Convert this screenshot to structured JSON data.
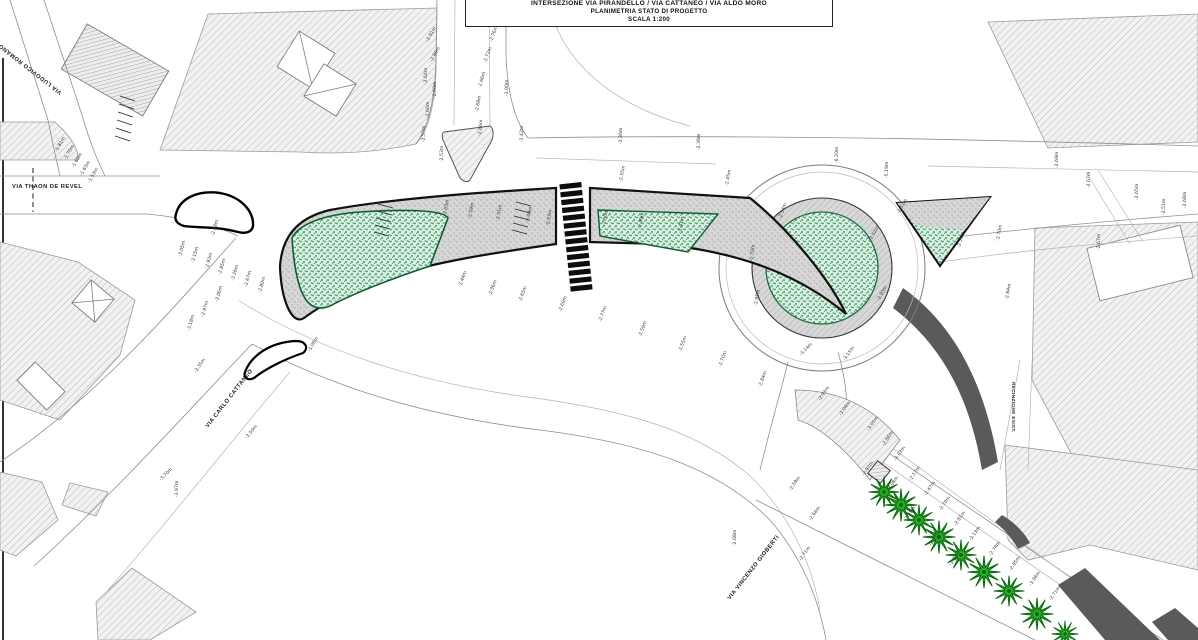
{
  "title_block": {
    "line1": "INTERSEZIONE VIA PIRANDELLO / VIA CATTANEO / VIA ALDO MORO",
    "line2": "PLANIMETRIA STATO DI PROGETTO",
    "line3": "SCALA 1:200"
  },
  "colors": {
    "island_green_dot": "#2f9a57",
    "island_green_base": "#daf0e3",
    "tree_green": "#2fb82a",
    "tree_green_dark": "#0c6b10",
    "apron_gray": "#d8d8d8",
    "median_gray": "#d7d7d7",
    "dark_strip": "#5a5a5a",
    "road_line_gray": "#8f8f8f",
    "outline_black": "#111111",
    "crosswalk_black": "#0d0d0d"
  },
  "street_labels": [
    {
      "text": "VIA THAON DE REVEL",
      "x": 12,
      "y": 188,
      "rot": 0
    },
    {
      "text": "VIA LUDOVICO ROMANO",
      "x": 62,
      "y": 92,
      "rot": 218
    },
    {
      "text": "VIA CARLO CATTANEO",
      "x": 208,
      "y": 428,
      "rot": -52
    },
    {
      "text": "VIA VINCENZO GIOBERTI",
      "x": 730,
      "y": 600,
      "rot": -52
    }
  ],
  "vertical_labels": [
    {
      "text": "RECINZIONE ESIST.",
      "x": 1012,
      "y": 382,
      "rot": 90
    }
  ],
  "crosswalk": {
    "cx": 575,
    "cy": 237,
    "x": 565,
    "y0": 183,
    "count": 14,
    "w": 22,
    "h": 5.2,
    "step": 7.9,
    "rot": -6
  },
  "trees": [
    {
      "x": 884,
      "y": 492,
      "r": 15
    },
    {
      "x": 901,
      "y": 505,
      "r": 16
    },
    {
      "x": 919,
      "y": 520,
      "r": 15
    },
    {
      "x": 939,
      "y": 537,
      "r": 16
    },
    {
      "x": 961,
      "y": 555,
      "r": 15
    },
    {
      "x": 984,
      "y": 572,
      "r": 16
    },
    {
      "x": 1009,
      "y": 591,
      "r": 15
    },
    {
      "x": 1037,
      "y": 614,
      "r": 16
    },
    {
      "x": 1065,
      "y": 634,
      "r": 13
    }
  ],
  "elevations": [
    {
      "x": 57,
      "y": 152,
      "r": -60,
      "t": "-1.81m"
    },
    {
      "x": 66,
      "y": 160,
      "r": -60,
      "t": "-1.70m"
    },
    {
      "x": 74,
      "y": 168,
      "r": -60,
      "t": "-1.68m"
    },
    {
      "x": 82,
      "y": 176,
      "r": -60,
      "t": "-1.63m"
    },
    {
      "x": 90,
      "y": 183,
      "r": -60,
      "t": "-1.53m"
    },
    {
      "x": 428,
      "y": 42,
      "r": -60,
      "t": "-2.91m"
    },
    {
      "x": 432,
      "y": 62,
      "r": -60,
      "t": "-2.86m"
    },
    {
      "x": 427,
      "y": 84,
      "r": -90,
      "t": "-2.64m"
    },
    {
      "x": 436,
      "y": 98,
      "r": -90,
      "t": "-2.60m"
    },
    {
      "x": 429,
      "y": 118,
      "r": -90,
      "t": "-2.66m"
    },
    {
      "x": 425,
      "y": 142,
      "r": -90,
      "t": "-2.57m"
    },
    {
      "x": 443,
      "y": 162,
      "r": -90,
      "t": "-2.53m"
    },
    {
      "x": 492,
      "y": 42,
      "r": -70,
      "t": "-2.76m"
    },
    {
      "x": 486,
      "y": 63,
      "r": -70,
      "t": "-2.72m"
    },
    {
      "x": 481,
      "y": 88,
      "r": -75,
      "t": "-2.66m"
    },
    {
      "x": 478,
      "y": 112,
      "r": -80,
      "t": "-2.68m"
    },
    {
      "x": 481,
      "y": 136,
      "r": -85,
      "t": "-2.86m"
    },
    {
      "x": 508,
      "y": 96,
      "r": -90,
      "t": "-3.00m"
    },
    {
      "x": 523,
      "y": 142,
      "r": -90,
      "t": "-2.42m"
    },
    {
      "x": 622,
      "y": 144,
      "r": -90,
      "t": "-2.36m"
    },
    {
      "x": 700,
      "y": 150,
      "r": -90,
      "t": "-2.38m"
    },
    {
      "x": 838,
      "y": 163,
      "r": -90,
      "t": "-6.20m"
    },
    {
      "x": 888,
      "y": 178,
      "r": -90,
      "t": "-5.19m"
    },
    {
      "x": 1058,
      "y": 168,
      "r": -90,
      "t": "-2.69m"
    },
    {
      "x": 1090,
      "y": 188,
      "r": -90,
      "t": "-2.67m"
    },
    {
      "x": 1138,
      "y": 200,
      "r": -90,
      "t": "-2.65m"
    },
    {
      "x": 1165,
      "y": 215,
      "r": -90,
      "t": "-2.51m"
    },
    {
      "x": 1186,
      "y": 208,
      "r": -90,
      "t": "-2.68m"
    },
    {
      "x": 181,
      "y": 257,
      "r": -75,
      "t": "-3.05m"
    },
    {
      "x": 194,
      "y": 263,
      "r": -75,
      "t": "-3.15m"
    },
    {
      "x": 208,
      "y": 269,
      "r": -75,
      "t": "-2.93m"
    },
    {
      "x": 221,
      "y": 275,
      "r": -75,
      "t": "-2.85m"
    },
    {
      "x": 234,
      "y": 281,
      "r": -75,
      "t": "-3.26m"
    },
    {
      "x": 247,
      "y": 287,
      "r": -75,
      "t": "-2.67m"
    },
    {
      "x": 261,
      "y": 293,
      "r": -75,
      "t": "-2.80m"
    },
    {
      "x": 218,
      "y": 302,
      "r": -75,
      "t": "-3.06m"
    },
    {
      "x": 204,
      "y": 317,
      "r": -75,
      "t": "-2.97m"
    },
    {
      "x": 190,
      "y": 331,
      "r": -75,
      "t": "-3.18m"
    },
    {
      "x": 214,
      "y": 236,
      "r": -75,
      "t": "-2.88m"
    },
    {
      "x": 446,
      "y": 216,
      "r": -80,
      "t": "-2.63m"
    },
    {
      "x": 471,
      "y": 219,
      "r": -80,
      "t": "-2.59m"
    },
    {
      "x": 499,
      "y": 221,
      "r": -80,
      "t": "-2.51m"
    },
    {
      "x": 529,
      "y": 223,
      "r": -80,
      "t": "-2.48m"
    },
    {
      "x": 549,
      "y": 226,
      "r": -80,
      "t": "-2.63m"
    },
    {
      "x": 605,
      "y": 226,
      "r": -80,
      "t": "-2.55m"
    },
    {
      "x": 641,
      "y": 229,
      "r": -80,
      "t": "-2.49m"
    },
    {
      "x": 681,
      "y": 233,
      "r": -80,
      "t": "-2.41m"
    },
    {
      "x": 461,
      "y": 287,
      "r": -70,
      "t": "-2.44m"
    },
    {
      "x": 491,
      "y": 296,
      "r": -70,
      "t": "-2.36m"
    },
    {
      "x": 521,
      "y": 302,
      "r": -70,
      "t": "-2.65m"
    },
    {
      "x": 561,
      "y": 312,
      "r": -70,
      "t": "-2.69m"
    },
    {
      "x": 601,
      "y": 322,
      "r": -70,
      "t": "-2.77m"
    },
    {
      "x": 641,
      "y": 337,
      "r": -70,
      "t": "-2.59m"
    },
    {
      "x": 681,
      "y": 352,
      "r": -70,
      "t": "-2.55m"
    },
    {
      "x": 721,
      "y": 367,
      "r": -70,
      "t": "-2.70m"
    },
    {
      "x": 761,
      "y": 387,
      "r": -70,
      "t": "-2.84m"
    },
    {
      "x": 622,
      "y": 182,
      "r": -80,
      "t": "-2.55m"
    },
    {
      "x": 728,
      "y": 186,
      "r": -80,
      "t": "-2.45m"
    },
    {
      "x": 781,
      "y": 219,
      "r": -70,
      "t": "-2.54m"
    },
    {
      "x": 899,
      "y": 214,
      "r": -60,
      "t": "-2.51m"
    },
    {
      "x": 871,
      "y": 241,
      "r": -60,
      "t": "-2.52m"
    },
    {
      "x": 879,
      "y": 301,
      "r": -60,
      "t": "-2.93m"
    },
    {
      "x": 753,
      "y": 261,
      "r": -85,
      "t": "-2.70m"
    },
    {
      "x": 757,
      "y": 306,
      "r": -80,
      "t": "-2.95m"
    },
    {
      "x": 801,
      "y": 356,
      "r": -45,
      "t": "-3.14m"
    },
    {
      "x": 845,
      "y": 361,
      "r": -55,
      "t": "-3.15m"
    },
    {
      "x": 999,
      "y": 241,
      "r": -80,
      "t": "-2.70m"
    },
    {
      "x": 1008,
      "y": 300,
      "r": -80,
      "t": "-2.84m"
    },
    {
      "x": 960,
      "y": 248,
      "r": -75,
      "t": "-2.51m"
    },
    {
      "x": 1100,
      "y": 250,
      "r": -90,
      "t": "-2.67m"
    },
    {
      "x": 820,
      "y": 401,
      "r": -55,
      "t": "-2.93m"
    },
    {
      "x": 841,
      "y": 416,
      "r": -55,
      "t": "-3.04m"
    },
    {
      "x": 869,
      "y": 431,
      "r": -55,
      "t": "-3.05m"
    },
    {
      "x": 884,
      "y": 446,
      "r": -55,
      "t": "-2.86m"
    },
    {
      "x": 896,
      "y": 461,
      "r": -55,
      "t": "-3.03m"
    },
    {
      "x": 864,
      "y": 476,
      "r": -55,
      "t": "-2.97m"
    },
    {
      "x": 889,
      "y": 491,
      "r": -55,
      "t": "-3.08m"
    },
    {
      "x": 911,
      "y": 481,
      "r": -55,
      "t": "-2.57m"
    },
    {
      "x": 926,
      "y": 496,
      "r": -55,
      "t": "-2.47m"
    },
    {
      "x": 941,
      "y": 511,
      "r": -55,
      "t": "-2.70m"
    },
    {
      "x": 956,
      "y": 526,
      "r": -55,
      "t": "-2.81m"
    },
    {
      "x": 971,
      "y": 541,
      "r": -55,
      "t": "-3.13m"
    },
    {
      "x": 991,
      "y": 556,
      "r": -55,
      "t": "-2.74m"
    },
    {
      "x": 1011,
      "y": 571,
      "r": -55,
      "t": "-2.95m"
    },
    {
      "x": 1031,
      "y": 586,
      "r": -55,
      "t": "-3.06m"
    },
    {
      "x": 1051,
      "y": 601,
      "r": -55,
      "t": "-2.71m"
    },
    {
      "x": 931,
      "y": 546,
      "r": -55,
      "t": "-2.97m"
    },
    {
      "x": 951,
      "y": 566,
      "r": -55,
      "t": "-3.03m"
    },
    {
      "x": 906,
      "y": 521,
      "r": -55,
      "t": "-2.55m"
    },
    {
      "x": 791,
      "y": 491,
      "r": -55,
      "t": "-2.59m"
    },
    {
      "x": 811,
      "y": 521,
      "r": -55,
      "t": "-2.66m"
    },
    {
      "x": 736,
      "y": 546,
      "r": -90,
      "t": "-2.68m"
    },
    {
      "x": 801,
      "y": 561,
      "r": -55,
      "t": "-2.71m"
    },
    {
      "x": 161,
      "y": 481,
      "r": -45,
      "t": "-3.70m"
    },
    {
      "x": 178,
      "y": 497,
      "r": -90,
      "t": "-3.97m"
    },
    {
      "x": 247,
      "y": 439,
      "r": -50,
      "t": "-3.50m"
    },
    {
      "x": 196,
      "y": 373,
      "r": -55,
      "t": "-3.35m"
    },
    {
      "x": 310,
      "y": 352,
      "r": -60,
      "t": "-3.06m"
    }
  ]
}
